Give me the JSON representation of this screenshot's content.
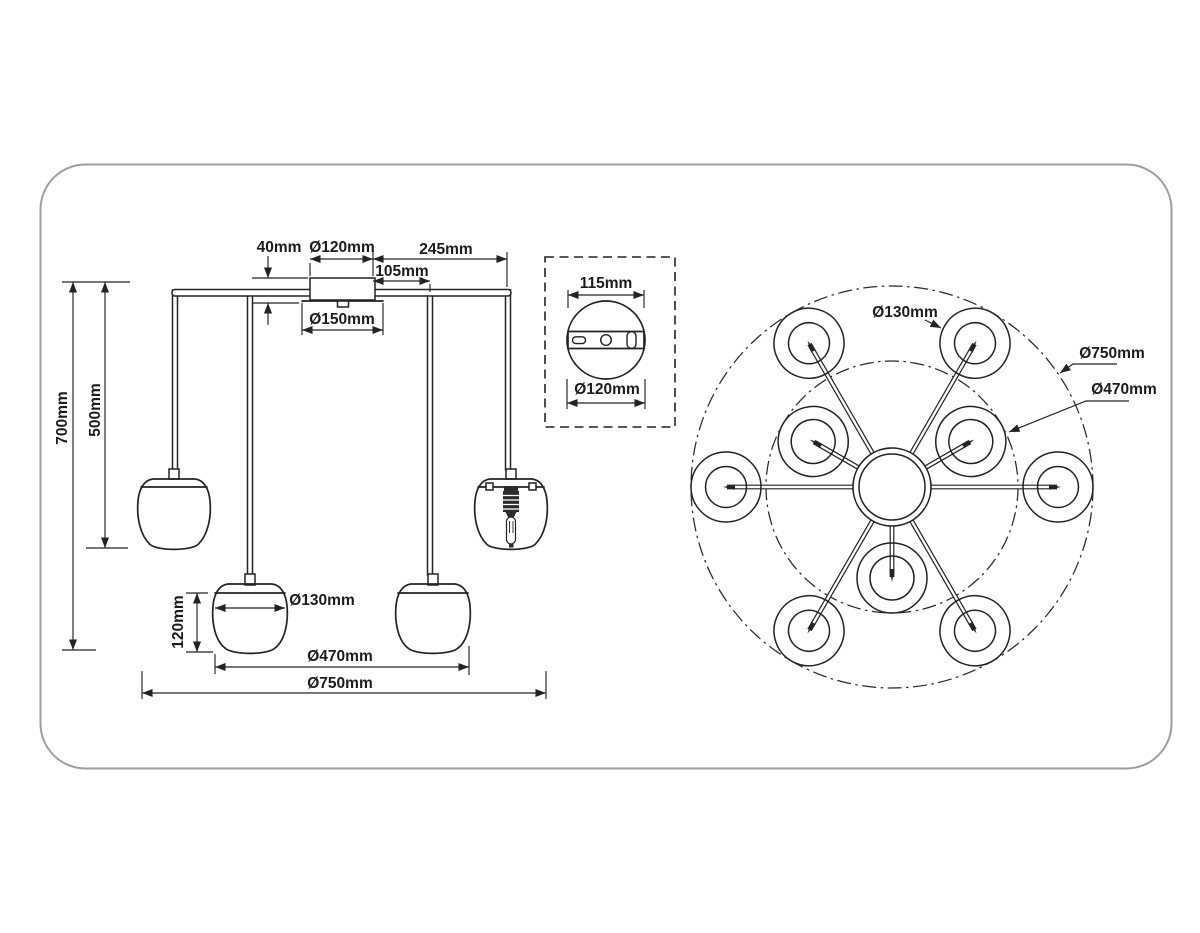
{
  "meta": {
    "description": "Technical dimension drawing of a multi-arm pendant chandelier with dome glass shades",
    "views": [
      "front elevation",
      "ceiling canopy detail",
      "top plan view"
    ]
  },
  "colors": {
    "line": "#232323",
    "frame_border": "#9e9e9e",
    "text": "#1c1c1c",
    "background": "#ffffff"
  },
  "side_view": {
    "name": "front-elevation",
    "labels": {
      "arm_height": "40mm",
      "canopy_diameter": "Ø120mm",
      "arm_length": "245mm",
      "inner_arm_length": "105mm",
      "canopy_plate_diameter": "Ø150mm",
      "total_drop": "700mm",
      "upper_shade_drop": "500mm",
      "shade_height": "120mm",
      "shade_diameter": "Ø130mm",
      "inner_spread_diameter": "Ø470mm",
      "outer_spread_diameter": "Ø750mm"
    }
  },
  "canopy_detail": {
    "name": "ceiling-canopy-detail",
    "labels": {
      "bracket_width": "115mm",
      "canopy_diameter": "Ø120mm"
    }
  },
  "plan_view": {
    "name": "top-plan-view",
    "labels": {
      "shade_diameter": "Ø130mm",
      "outer_diameter": "Ø750mm",
      "inner_diameter": "Ø470mm"
    }
  }
}
